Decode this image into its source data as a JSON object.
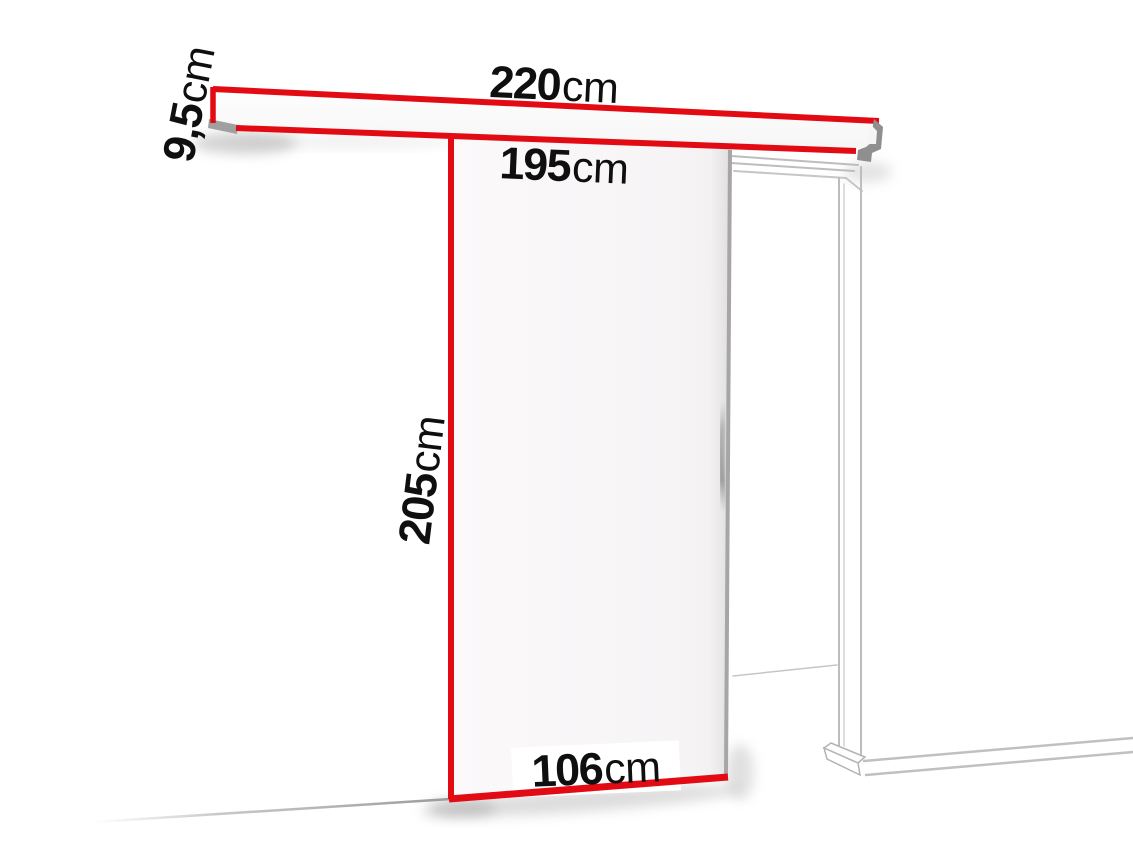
{
  "colors": {
    "highlight_red": "#e30b13",
    "frame_line_gray": "#bdbdbd",
    "end_cap_gray": "#8f8f8f",
    "text_black": "#0f0f0f",
    "background": "#ffffff"
  },
  "dimensions": {
    "rail_length": {
      "value": "220",
      "unit": "cm"
    },
    "rail_height": {
      "value": "9,5",
      "unit": "cm"
    },
    "opening_width": {
      "value": "195",
      "unit": "cm"
    },
    "door_height": {
      "value": "205",
      "unit": "cm"
    },
    "door_width": {
      "value": "106",
      "unit": "cm"
    }
  }
}
